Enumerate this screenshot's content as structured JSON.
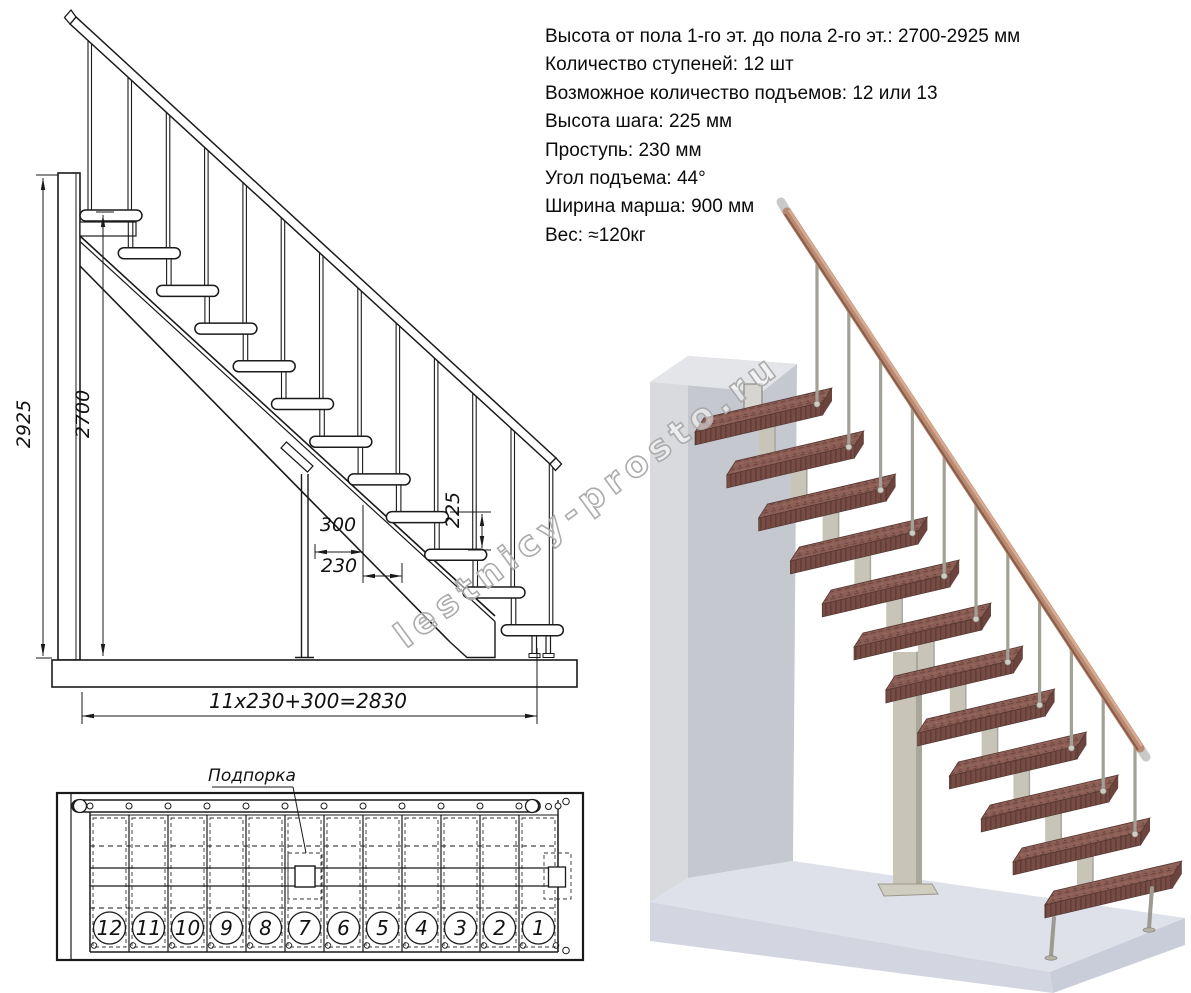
{
  "specs": {
    "lines": [
      "Высота от пола 1-го эт. до пола 2-го эт.: 2700-2925 мм",
      "Количество ступеней: 12 шт",
      "Возможное количество подъемов: 12 или 13",
      "Высота шага: 225 мм",
      "Проступь: 230 мм",
      "Угол подъема: 44°",
      "Ширина марша: 900 мм",
      "Вес: ≈120кг"
    ]
  },
  "elevation": {
    "dims": {
      "total_height": "2925",
      "floor_height": "2700",
      "depth": "300",
      "run": "230",
      "rise": "225",
      "total_run": "11x230+300=2830"
    }
  },
  "plan": {
    "support_label": "Подпорка",
    "step_numbers": [
      "12",
      "11",
      "10",
      "9",
      "8",
      "7",
      "6",
      "5",
      "4",
      "3",
      "2",
      "1"
    ]
  },
  "watermark": {
    "text": "lestnicy-prosto.ru"
  },
  "colors": {
    "line": "#1a1a1a",
    "watermark": "#ababab",
    "wall": "#c6c8d0",
    "wall_side": "#d9dade",
    "wall_top": "#e4e5e9",
    "floor_top": "#dfe1ea",
    "floor_front": "#d3d5e0",
    "floor_right": "#c9ccd9",
    "tread_top": "#8c5f56",
    "tread_front": "#764c44",
    "tread_end": "#6b443d",
    "support": "#c8c5b8",
    "support_shade": "#a9a69a",
    "baluster": "#a3a196",
    "handrail": "#b98a72",
    "handrail_light": "#d9ac92",
    "handrail_dark": "#8a5d4b",
    "metal_cap": "#c9c9c9"
  }
}
